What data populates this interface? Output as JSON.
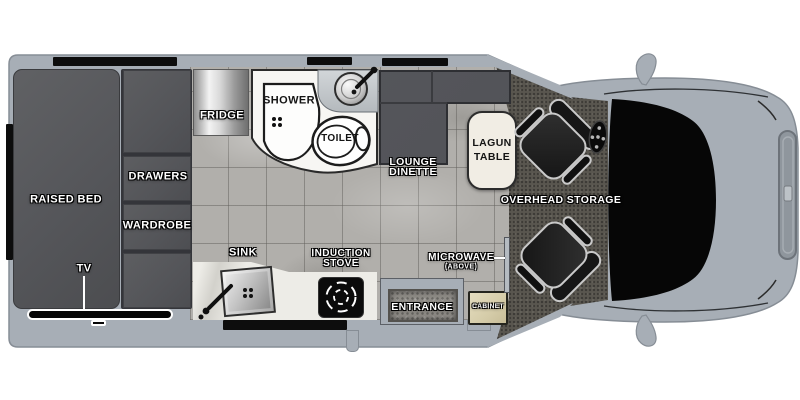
{
  "floorplan": {
    "bedroom": {
      "raised_bed": "RAISED BED",
      "drawers": "DRAWERS",
      "wardrobe": "WARDROBE",
      "tv": "TV"
    },
    "bathroom": {
      "shower": "SHOWER",
      "toilet": "TOILET"
    },
    "kitchen": {
      "fridge": "FRIDGE",
      "sink": "SINK",
      "induction_stove_line1": "INDUCTION",
      "induction_stove_line2": "STOVE",
      "microwave_line1": "MICROWAVE",
      "microwave_line2": "(ABOVE)",
      "cabinet": "CABINET"
    },
    "living": {
      "lounge_line1": "LOUNGE",
      "lounge_line2": "DINETTE",
      "lagun_line1": "LAGUN",
      "lagun_line2": "TABLE",
      "overhead_storage": "OVERHEAD STORAGE"
    },
    "entry": {
      "entrance": "ENTRANCE"
    }
  },
  "colors": {
    "background": "#ffffff",
    "body_gray": "#a7aeb6",
    "furniture_dark": "#54555a",
    "floor_tile": "#b1afab",
    "cab_carpet": "#59564f",
    "counter_white": "#edece7",
    "cabinet_tan": "#d5cca9",
    "table_cream": "#f1ede4",
    "windshield_black": "#060606",
    "window_black": "#0d0d0d",
    "label_white": "#ffffff",
    "label_dark": "#141414"
  }
}
